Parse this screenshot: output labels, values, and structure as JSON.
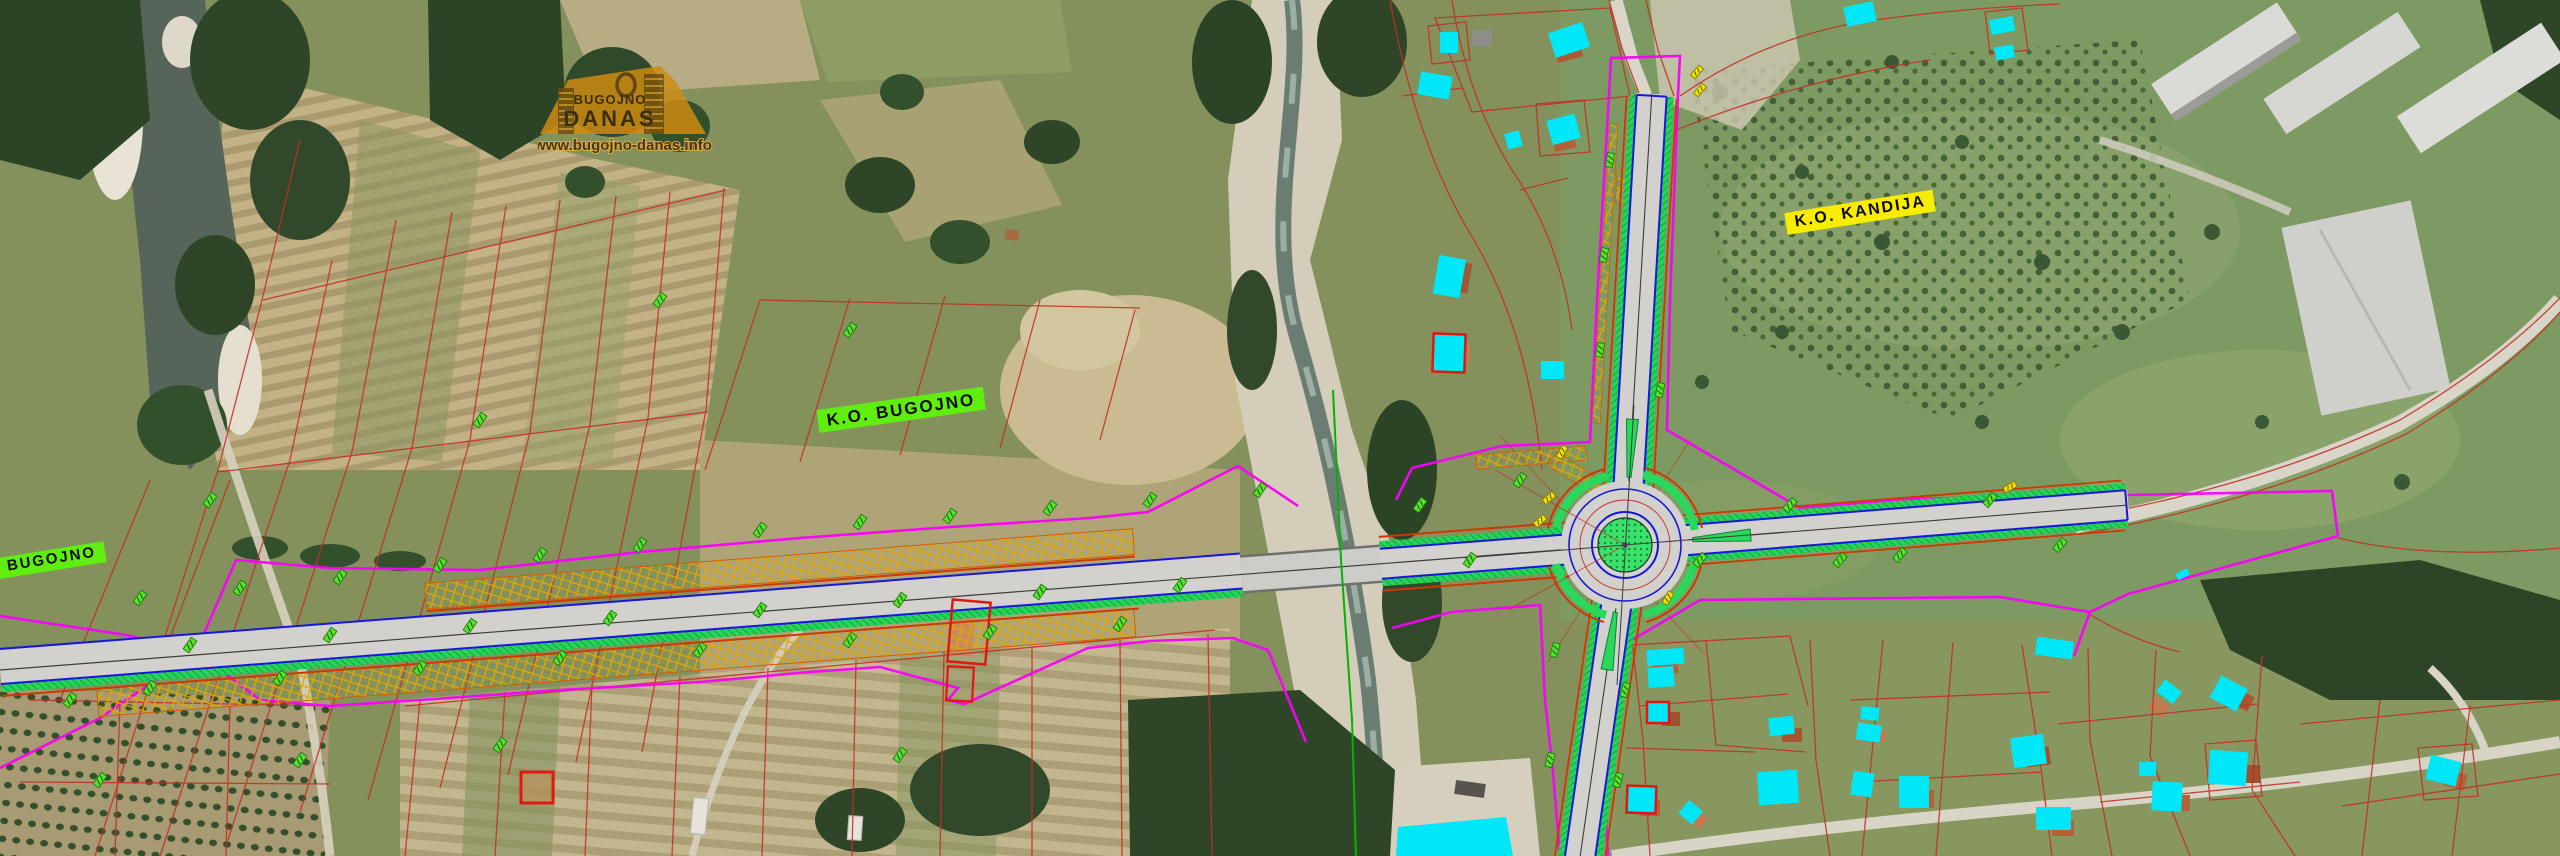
{
  "map": {
    "title": "Bugojno bypass road design over orthophoto",
    "labels": {
      "ko_bugojno": "K.O.  BUGOJNO",
      "ko_kandija": "K.O.  KANDIJA",
      "bugojno": "BUGOJNO"
    },
    "watermark": {
      "top": "BUGOJNO",
      "main": "DANAS",
      "url": "www.bugojno-danas.info"
    },
    "legend_colors": {
      "cadastral_parcel_line": "#c23026",
      "expropriation_boundary": "#fa00fa",
      "building_highlight": "#00e8f8",
      "road_edge_blue": "#1818d8",
      "green_verge_strip": "#2ad85c",
      "embankment_hatch": "#e0a800",
      "curb_line_orange": "#cc3a00",
      "label_box_green": "#5fee10",
      "label_box_yellow": "#f8ec00",
      "river_regulation_line": "#00b400"
    },
    "features": [
      "orthophoto-terrain",
      "river-left",
      "river-central",
      "bridge",
      "designed-road-west",
      "roundabout",
      "north-arm",
      "south-arm",
      "east-arm",
      "existing-road-east",
      "cadastral-network",
      "highlighted-buildings",
      "chainage-markers"
    ]
  }
}
